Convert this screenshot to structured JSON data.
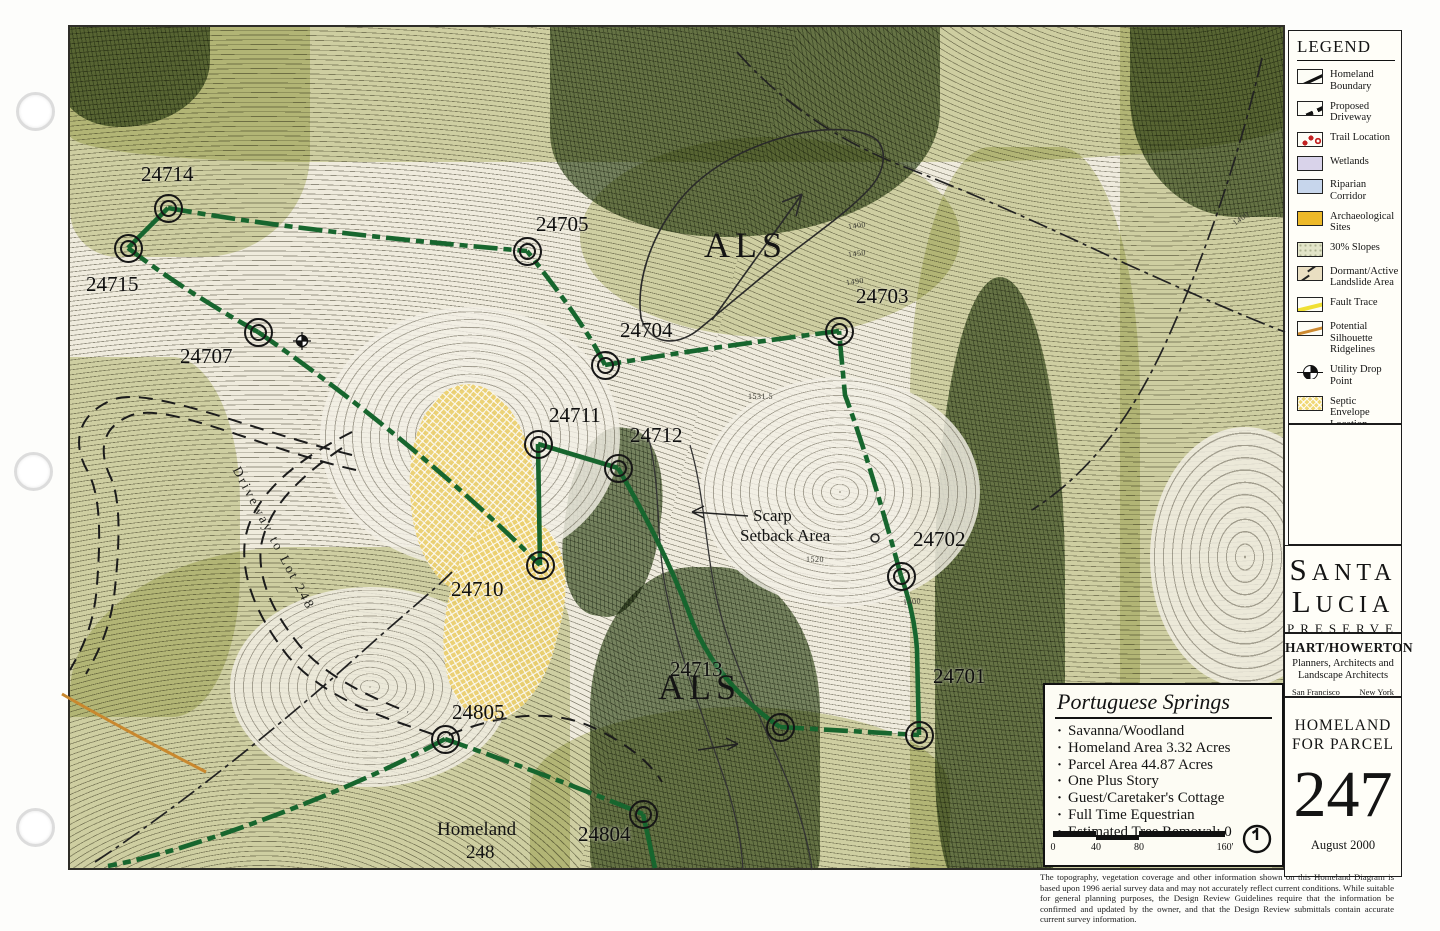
{
  "map": {
    "parcel_labels": [
      {
        "id": "24714",
        "lx": 141,
        "ly": 162,
        "mx": 168,
        "my": 208
      },
      {
        "id": "24715",
        "lx": 86,
        "ly": 272,
        "mx": 128,
        "my": 248
      },
      {
        "id": "24707",
        "lx": 180,
        "ly": 344,
        "mx": 258,
        "my": 332
      },
      {
        "id": "24705",
        "lx": 536,
        "ly": 212,
        "mx": 527,
        "my": 251
      },
      {
        "id": "24704",
        "lx": 620,
        "ly": 318,
        "mx": 605,
        "my": 365
      },
      {
        "id": "24703",
        "lx": 856,
        "ly": 284,
        "mx": 839,
        "my": 331
      },
      {
        "id": "24711",
        "lx": 549,
        "ly": 403,
        "mx": 538,
        "my": 444
      },
      {
        "id": "24712",
        "lx": 630,
        "ly": 423,
        "mx": 618,
        "my": 468
      },
      {
        "id": "24710",
        "lx": 451,
        "ly": 577,
        "mx": 540,
        "my": 565
      },
      {
        "id": "24702",
        "lx": 913,
        "ly": 527,
        "mx": 901,
        "my": 576
      },
      {
        "id": "24701",
        "lx": 933,
        "ly": 664,
        "mx": 919,
        "my": 735
      },
      {
        "id": "24713",
        "lx": 670,
        "ly": 657,
        "mx": 780,
        "my": 727
      },
      {
        "id": "24805",
        "lx": 452,
        "ly": 700,
        "mx": 445,
        "my": 739
      },
      {
        "id": "24804",
        "lx": 578,
        "ly": 822,
        "mx": 643,
        "my": 814
      }
    ],
    "area_labels": [
      {
        "text": "ALS",
        "x": 704,
        "y": 224,
        "size": 36,
        "ls": 5
      },
      {
        "text": "ALS",
        "x": 658,
        "y": 666,
        "size": 36,
        "ls": 5
      },
      {
        "text": "Scarp",
        "x": 753,
        "y": 506,
        "size": 17,
        "ls": 0
      },
      {
        "text": "Setback Area",
        "x": 740,
        "y": 526,
        "size": 17,
        "ls": 0
      },
      {
        "text": "Homeland",
        "x": 437,
        "y": 819,
        "size": 19,
        "ls": 0
      },
      {
        "text": "248",
        "x": 466,
        "y": 842,
        "size": 19,
        "ls": 0
      }
    ],
    "driveway_label": "Driveway to Lot 248",
    "elevation_labels": [
      {
        "text": "1400",
        "x": 848,
        "y": 221,
        "rot": -8
      },
      {
        "text": "1450",
        "x": 848,
        "y": 249,
        "rot": -8
      },
      {
        "text": "1490",
        "x": 846,
        "y": 277,
        "rot": -8
      },
      {
        "text": "1531.5",
        "x": 748,
        "y": 392,
        "rot": 0
      },
      {
        "text": "1520",
        "x": 806,
        "y": 555,
        "rot": 0
      },
      {
        "text": "1400",
        "x": 903,
        "y": 597,
        "rot": -5
      },
      {
        "text": "1400",
        "x": 1232,
        "y": 214,
        "rot": -35
      }
    ]
  },
  "info_box": {
    "title": "Portuguese Springs",
    "bullets": [
      "Savanna/Woodland",
      "Homeland Area 3.32 Acres",
      "Parcel Area 44.87 Acres",
      "One Plus Story",
      "Guest/Caretaker's Cottage",
      "Full Time Equestrian",
      "Estimated Tree Removal: 0"
    ],
    "scale_ticks": [
      "0",
      "40",
      "80",
      "160'"
    ]
  },
  "legend": {
    "title": "LEGEND",
    "items": [
      {
        "label": "Homeland Boundary",
        "swatch": "homeland-boundary"
      },
      {
        "label": "Proposed Driveway",
        "swatch": "proposed-driveway"
      },
      {
        "label": "Trail Location",
        "swatch": "trail-location"
      },
      {
        "label": "Wetlands",
        "swatch": "wetlands"
      },
      {
        "label": "Riparian Corridor",
        "swatch": "riparian"
      },
      {
        "label": "Archaeological Sites",
        "swatch": "archaeological"
      },
      {
        "label": "30% Slopes",
        "swatch": "slopes"
      },
      {
        "label": "Dormant/Active Landslide Area",
        "swatch": "landslide"
      },
      {
        "label": "Fault Trace",
        "swatch": "fault"
      },
      {
        "label": "Potential Silhouette Ridgelines",
        "swatch": "ridgelines"
      },
      {
        "label": "Utility Drop Point",
        "swatch": "utility"
      },
      {
        "label": "Septic Envelope Location",
        "swatch": "septic"
      }
    ]
  },
  "branding": {
    "line1": "SANTA",
    "line2": "LUCIA",
    "line3": "PRESERVE",
    "firm": "HART/HOWERTON",
    "firm_sub": "Planners, Architects and Landscape Architects",
    "city_left": "San Francisco",
    "city_right": "New York"
  },
  "title_block": {
    "line1": "HOMELAND",
    "line2": "FOR  PARCEL",
    "parcel_number": "247",
    "date": "August 2000"
  },
  "disclaimer": "The topography, vegetation coverage and other information shown on this Homeland Diagram is based upon 1996 aerial survey data and may not accurately reflect current conditions. While suitable for general planning purposes, the Design Review Guidelines require that the information be confirmed and updated by the owner, and that the Design Review submittals contain accurate current survey information.",
  "colors": {
    "boundary_green": "#17662e",
    "septic_yellow": "#ecd06e",
    "trail_red": "#c22121",
    "ridgeline_orange": "#c9882e"
  }
}
